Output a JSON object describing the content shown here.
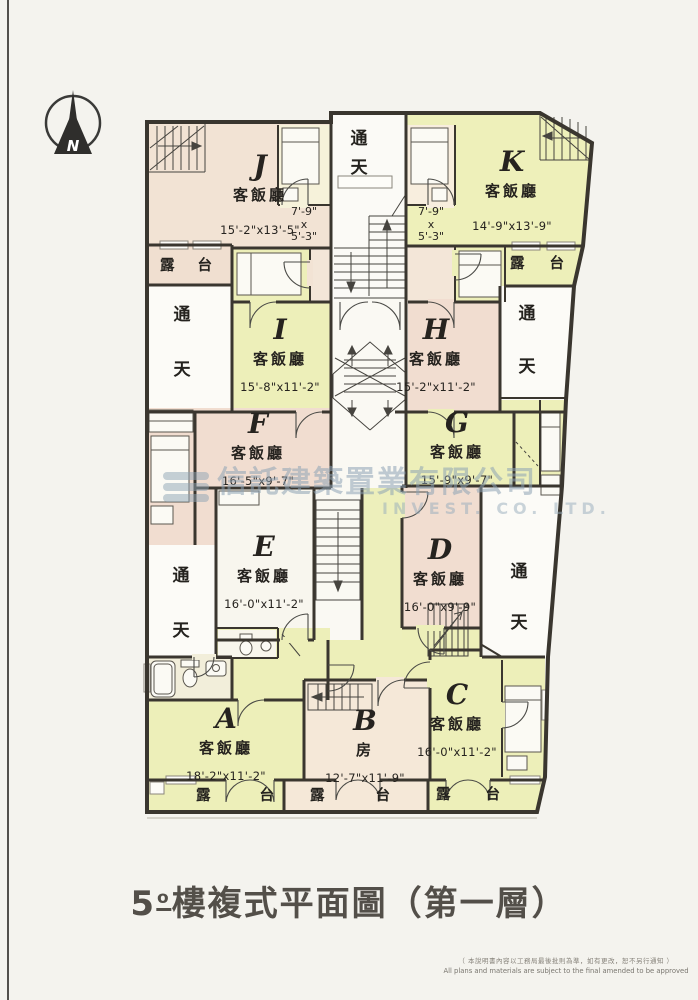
{
  "page": {
    "title": {
      "num": "5",
      "sup": "o",
      "rest": "樓複式平面圖（第一層）"
    },
    "disclaimer": {
      "zh": "（ 本說明書內容以工務局最後批則為準，如有更改，恕不另行通知 ）",
      "en": "All plans and materials are subject to the final amended to be approved"
    }
  },
  "compass": {
    "n": "N"
  },
  "watermark": {
    "zh": "信託建築置業有限公司",
    "en": "INVEST. CO. LTD."
  },
  "labels": {
    "living": "客飯廳",
    "room": "房",
    "void_a": "通",
    "void_b": "天",
    "balc_a": "露",
    "balc_b": "台"
  },
  "units": {
    "J": {
      "letter": "J",
      "type": "客飯廳",
      "dims": "15'-2\"x13'-5\""
    },
    "K": {
      "letter": "K",
      "type": "客飯廳",
      "dims": "14'-9\"x13'-9\""
    },
    "I": {
      "letter": "I",
      "type": "客飯廳",
      "dims": "15'-8\"x11'-2\""
    },
    "H": {
      "letter": "H",
      "type": "客飯廳",
      "dims": "15'-2\"x11'-2\""
    },
    "F": {
      "letter": "F",
      "type": "客飯廳",
      "dims": "16'-5\"x9'-7\""
    },
    "G": {
      "letter": "G",
      "type": "客飯廳",
      "dims": "15'-9\"x9'-7\""
    },
    "E": {
      "letter": "E",
      "type": "客飯廳",
      "dims": "16'-0\"x11'-2\""
    },
    "D": {
      "letter": "D",
      "type": "客飯廳",
      "dims": "16'-0\"x9'-9\""
    },
    "A": {
      "letter": "A",
      "type": "客飯廳",
      "dims": "18'-2\"x11'-2\""
    },
    "B": {
      "letter": "B",
      "type": "房",
      "dims": "12'-7\"x11'-9\""
    },
    "C": {
      "letter": "C",
      "type": "客飯廳",
      "dims": "16'-0\"x11'-2\""
    }
  },
  "small_rooms": {
    "left": {
      "w": "7'-9\"",
      "x": "x",
      "h": "5'-3\""
    },
    "right": {
      "w": "7'-9\"",
      "x": "x",
      "h": "5'-3\""
    }
  }
}
